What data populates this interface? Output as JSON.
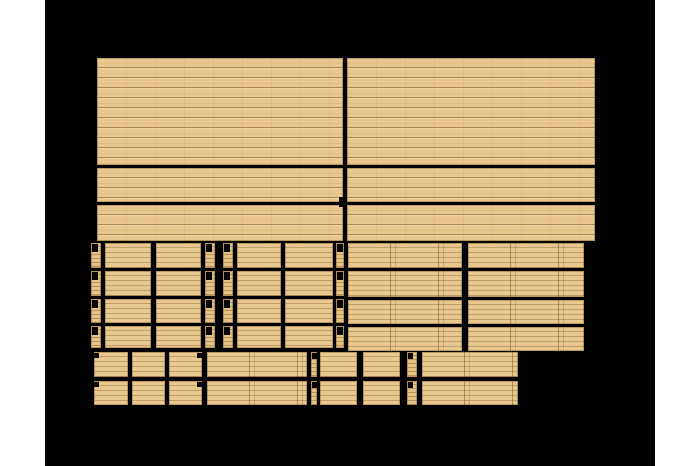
{
  "scene": {
    "colors": {
      "page_background": "#ffffff",
      "render_background": "#000000",
      "wood_base": "#e8c88e",
      "wood_grain": "#856045",
      "notch_mark": "#050505"
    },
    "canvas": {
      "x": 45,
      "y": 0,
      "w": 610,
      "h": 466
    },
    "top_pieces": [
      {
        "name": "top-left-panel",
        "x": 97,
        "y": 58,
        "w": 246,
        "h": 107
      },
      {
        "name": "top-right-panel",
        "x": 347,
        "y": 58,
        "w": 248,
        "h": 107
      },
      {
        "name": "top-left-band-1",
        "x": 97,
        "y": 168,
        "w": 246,
        "h": 34
      },
      {
        "name": "top-right-band-1",
        "x": 347,
        "y": 168,
        "w": 248,
        "h": 34
      },
      {
        "name": "top-left-band-2",
        "x": 97,
        "y": 205,
        "w": 246,
        "h": 36
      },
      {
        "name": "top-right-band-2",
        "x": 347,
        "y": 205,
        "w": 248,
        "h": 36
      }
    ],
    "middle": {
      "rows": [
        {
          "y": 243,
          "h": 25
        },
        {
          "y": 271,
          "h": 25
        },
        {
          "y": 299,
          "h": 24
        },
        {
          "y": 326,
          "h": 22
        }
      ],
      "framed_cols": [
        {
          "x": 91,
          "w": 10,
          "strip": true
        },
        {
          "x": 105,
          "w": 46
        },
        {
          "x": 156,
          "w": 45
        },
        {
          "x": 205,
          "w": 10,
          "strip": true
        },
        {
          "x": 223,
          "w": 10,
          "strip": true
        },
        {
          "x": 237,
          "w": 44
        },
        {
          "x": 285,
          "w": 48
        },
        {
          "x": 336,
          "w": 8,
          "strip": true
        }
      ],
      "board_rows": [
        {
          "y": 243,
          "h": 25
        },
        {
          "y": 271,
          "h": 26
        },
        {
          "y": 300,
          "h": 24
        },
        {
          "y": 327,
          "h": 24
        }
      ],
      "board_cols": [
        {
          "x": 348,
          "w": 114
        },
        {
          "x": 468,
          "w": 116
        }
      ]
    },
    "bottom": {
      "rows": [
        {
          "y": 352,
          "h": 25
        },
        {
          "y": 381,
          "h": 24
        }
      ],
      "cols": [
        {
          "x": 94,
          "w": 34
        },
        {
          "x": 132,
          "w": 33
        },
        {
          "x": 169,
          "w": 33
        },
        {
          "x": 207,
          "w": 100,
          "seams": true
        },
        {
          "x": 311,
          "w": 6,
          "strip": true
        },
        {
          "x": 320,
          "w": 37
        },
        {
          "x": 363,
          "w": 37
        },
        {
          "x": 407,
          "w": 10,
          "strip": true
        },
        {
          "x": 422,
          "w": 96,
          "seams": true
        }
      ]
    },
    "extra_marks": [
      {
        "x": 339,
        "y": 197,
        "w": 7,
        "h": 10
      },
      {
        "x": 94,
        "y": 353,
        "w": 5,
        "h": 5
      },
      {
        "x": 197,
        "y": 353,
        "w": 5,
        "h": 5
      },
      {
        "x": 94,
        "y": 382,
        "w": 5,
        "h": 5
      },
      {
        "x": 197,
        "y": 382,
        "w": 5,
        "h": 5
      }
    ]
  }
}
